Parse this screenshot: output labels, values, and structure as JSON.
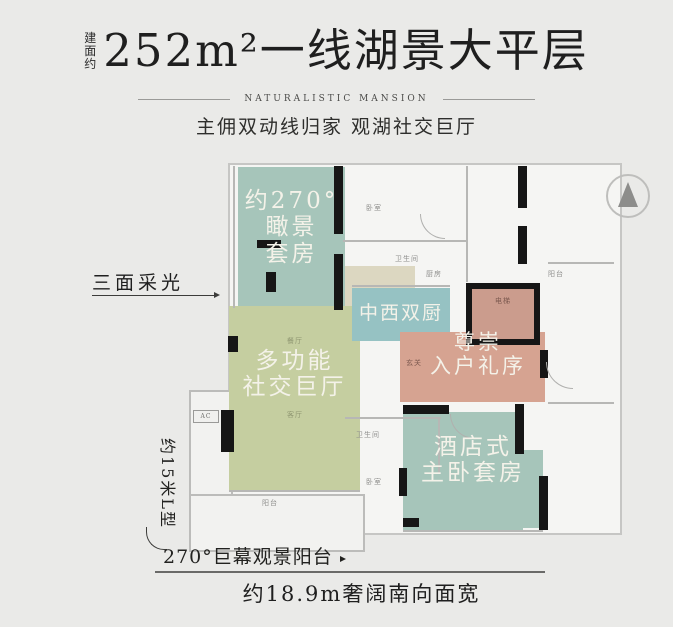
{
  "header": {
    "area_prefix": "建面约",
    "title": "252m²一线湖景大平层",
    "subtitle": "NATURALISTIC MANSION",
    "tagline": "主佣双动线归家 观湖社交巨厅"
  },
  "rooms": {
    "suite": {
      "line1": "约270°",
      "line2": "瞰景",
      "line3": "套房",
      "color": "#a6c5ba"
    },
    "hall": {
      "line1": "多功能",
      "line2": "社交巨厅",
      "color": "#c5cea0"
    },
    "kitchen": {
      "line1": "中西双厨",
      "color": "#96c2c3"
    },
    "entry": {
      "line1": "尊崇",
      "line2": "入户礼序",
      "color": "#d6a391"
    },
    "master": {
      "line1": "酒店式",
      "line2": "主卧套房",
      "color": "#a6c5ba"
    }
  },
  "small_labels": {
    "bedroom_top": "卧室",
    "bath_top": "卫生间",
    "kitchen_small": "厨房",
    "balcony_right": "阳台",
    "elevator": "电梯",
    "foyer": "玄关",
    "dining": "餐厅",
    "living": "客厅",
    "bath_bottom": "卫生间",
    "bedroom_bottom": "卧室",
    "balcony_bottom": "阳台",
    "ac": "AC"
  },
  "annotations": {
    "left_callout": "三面采光",
    "side_length": "约15米L型",
    "balcony_callout": "270°巨幕观景阳台",
    "bottom_width": "约18.9m奢阔南向面宽"
  },
  "colors": {
    "background": "#eaeae8",
    "floor": "#f5f5f3",
    "wall": "#161616",
    "suite_teal": "#a6c5ba",
    "hall_green": "#c5cea0",
    "kitchen_teal": "#96c2c3",
    "entry_pink": "#d6a391",
    "elevator_pink": "#cb9c8d",
    "title_text": "#1f1f1f"
  }
}
